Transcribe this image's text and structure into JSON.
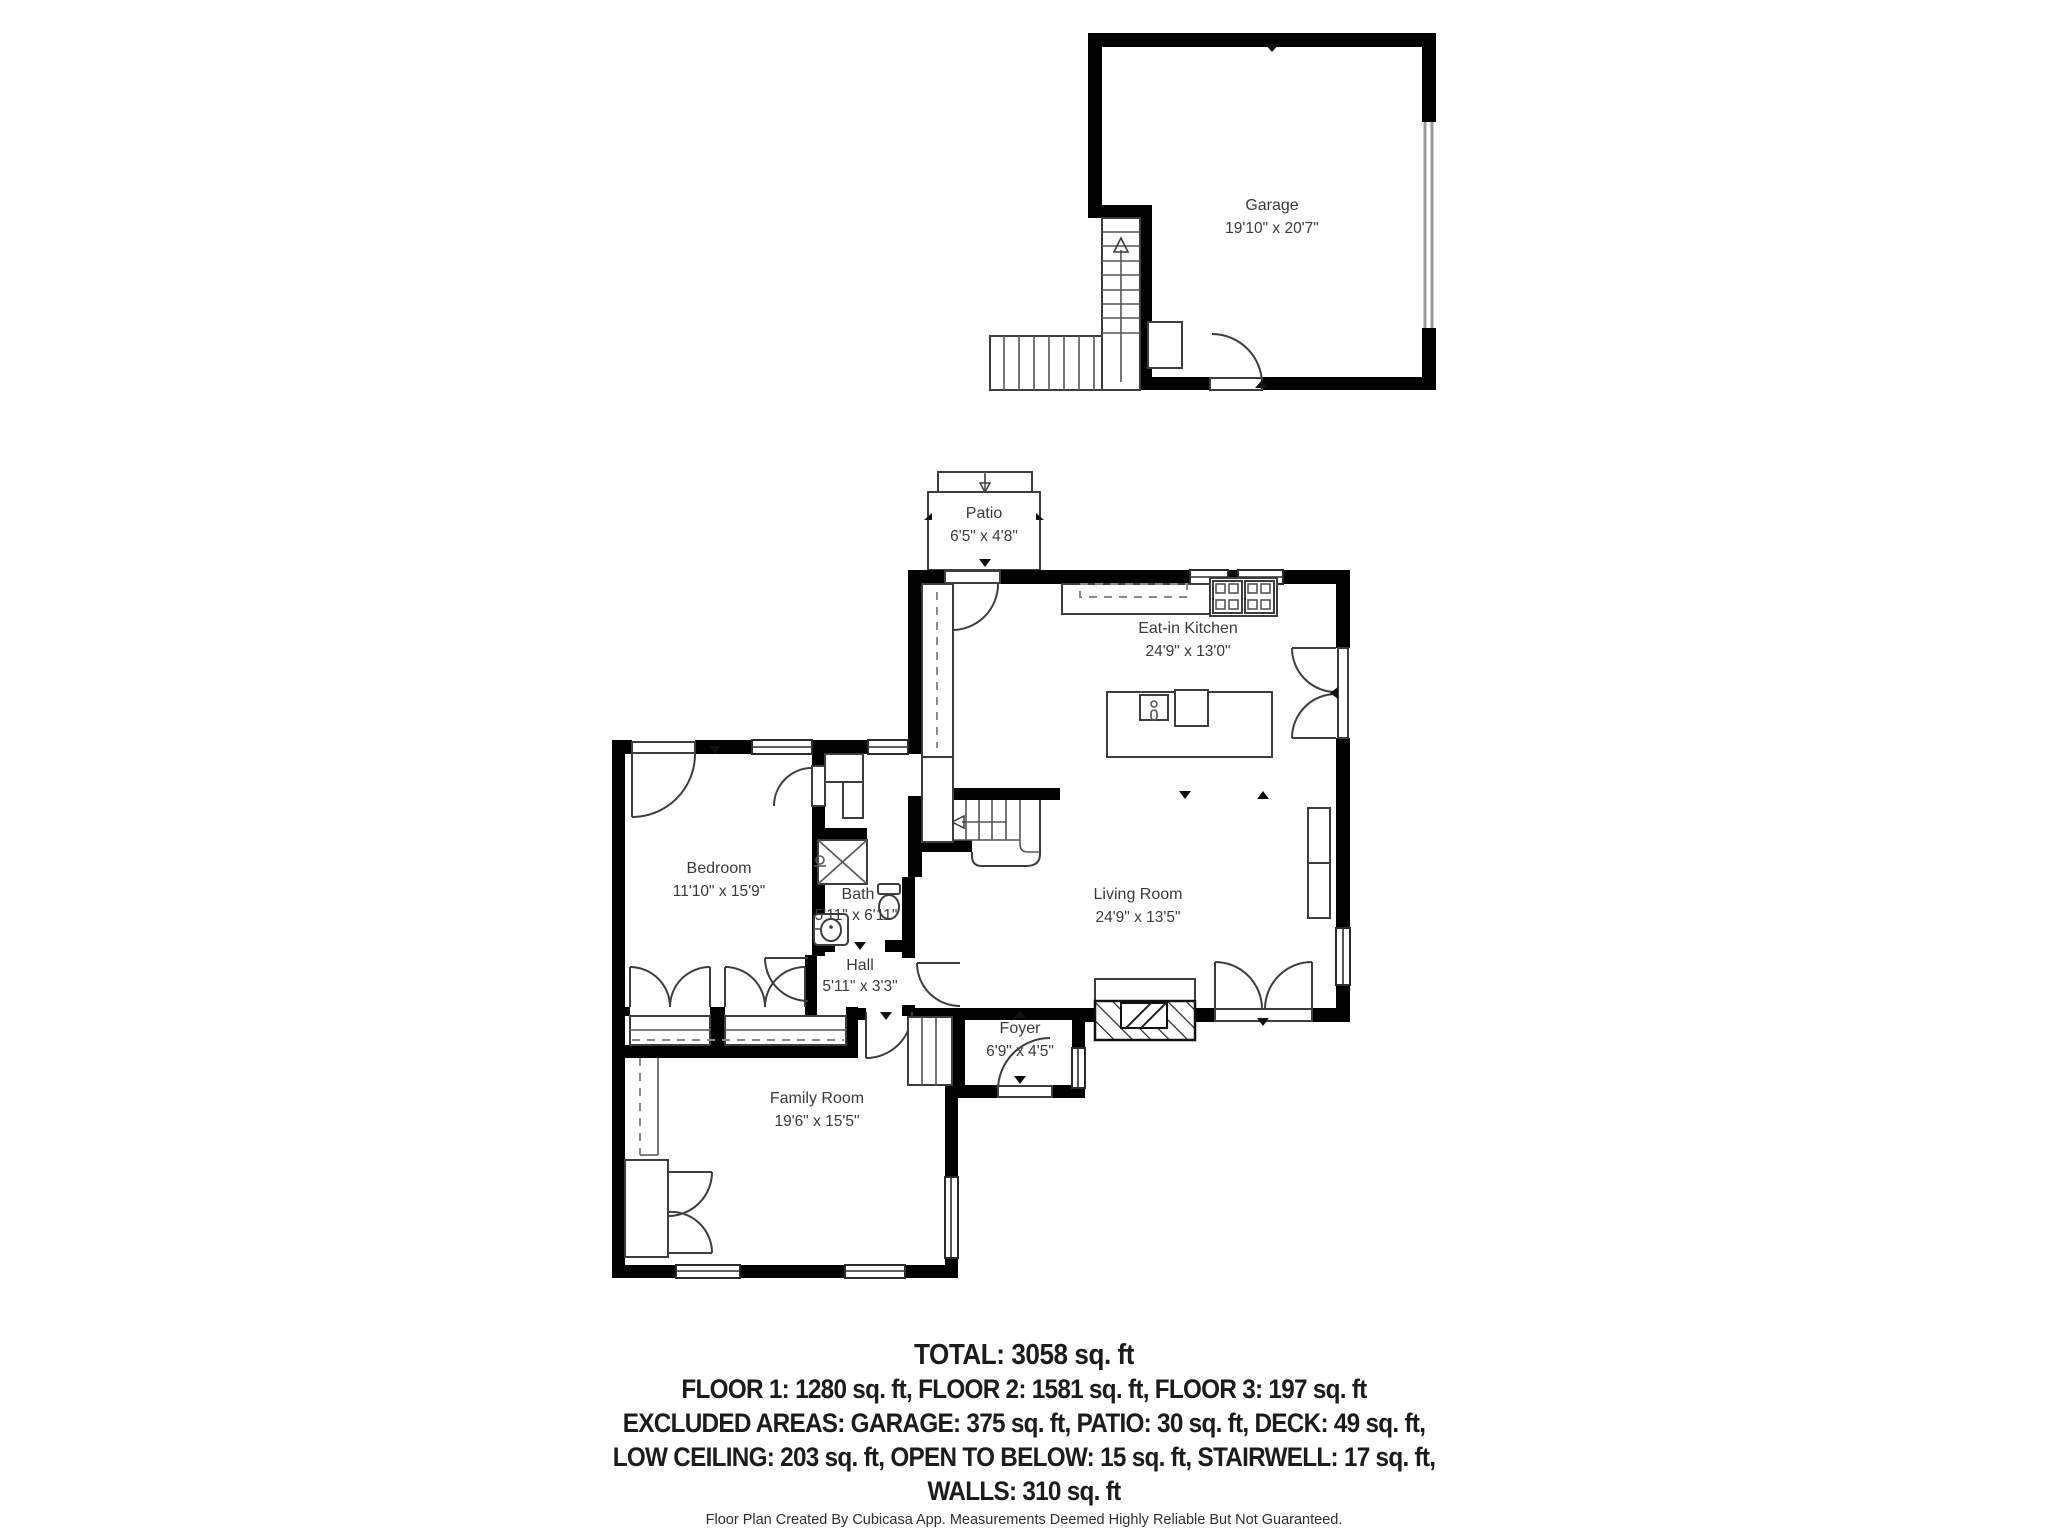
{
  "meta": {
    "colors": {
      "wall": "#000000",
      "thin_line": "#3d3d3d",
      "dashed_line": "#8a8a8a",
      "garage_door": "#9b9b9b",
      "label_text": "#3a3a3a",
      "summary_text": "#1c1c1c"
    }
  },
  "floorplan": {
    "rooms": {
      "garage": {
        "name": "Garage",
        "dims": "19'10\" x 20'7\""
      },
      "patio": {
        "name": "Patio",
        "dims": "6'5\" x 4'8\""
      },
      "kitchen": {
        "name": "Eat-in Kitchen",
        "dims": "24'9\" x 13'0\""
      },
      "bedroom": {
        "name": "Bedroom",
        "dims": "11'10\" x 15'9\""
      },
      "bath": {
        "name": "Bath",
        "dims": "5'11\" x 6'11\""
      },
      "hall": {
        "name": "Hall",
        "dims": "5'11\" x 3'3\""
      },
      "living": {
        "name": "Living Room",
        "dims": "24'9\" x 13'5\""
      },
      "foyer": {
        "name": "Foyer",
        "dims": "6'9\" x 4'5\""
      },
      "family": {
        "name": "Family Room",
        "dims": "19'6\" x 15'5\""
      }
    },
    "summary": {
      "total": "TOTAL: 3058 sq. ft",
      "lines": [
        "FLOOR 1: 1280 sq. ft, FLOOR 2: 1581 sq. ft, FLOOR 3: 197 sq. ft",
        "EXCLUDED AREAS: GARAGE: 375 sq. ft, PATIO: 30 sq. ft, DECK: 49 sq. ft,",
        "LOW CEILING: 203 sq. ft, OPEN TO BELOW: 15 sq. ft, STAIRWELL: 17 sq. ft,",
        "WALLS: 310 sq. ft"
      ]
    },
    "footer": "Floor Plan Created By Cubicasa App. Measurements Deemed Highly Reliable But Not Guaranteed."
  }
}
